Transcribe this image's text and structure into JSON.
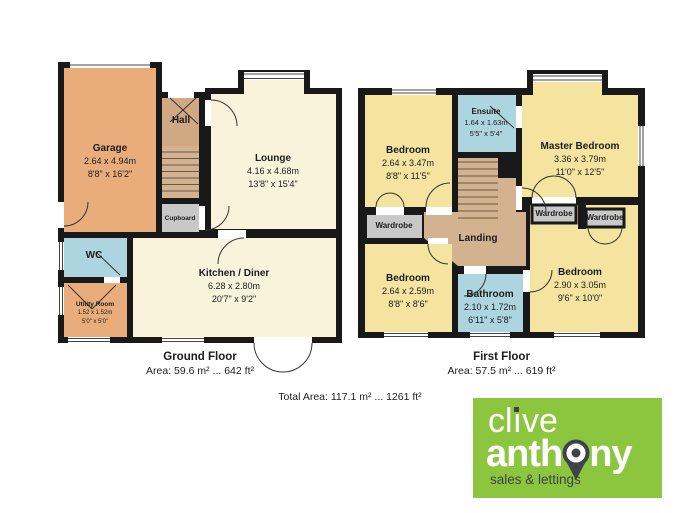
{
  "ground_floor": {
    "caption": "Ground Floor",
    "area": "Area: 59.6 m² ... 642 ft²",
    "rooms": {
      "garage": {
        "name": "Garage",
        "metric": "2.64 x 4.94m",
        "imperial": "8'8\" x 16'2\""
      },
      "hall": {
        "name": "Hall"
      },
      "lounge": {
        "name": "Lounge",
        "metric": "4.16 x 4.68m",
        "imperial": "13'8\" x 15'4\""
      },
      "cupboard": {
        "name": "Cupboard"
      },
      "wc": {
        "name": "WC"
      },
      "utility_room": {
        "name": "Utility Room",
        "metric": "1.52 x 1.52m",
        "imperial": "5'0\" x 5'0\""
      },
      "kitchen_diner": {
        "name": "Kitchen / Diner",
        "metric": "6.28 x 2.80m",
        "imperial": "20'7\" x 9'2\""
      }
    }
  },
  "first_floor": {
    "caption": "First Floor",
    "area": "Area: 57.5 m² ... 619 ft²",
    "rooms": {
      "bedroom_top_left": {
        "name": "Bedroom",
        "metric": "2.64 x 3.47m",
        "imperial": "8'8\" x 11'5\""
      },
      "ensuite": {
        "name": "Ensuite",
        "metric": "1.64 x 1.63m",
        "imperial": "5'5\" x 5'4\""
      },
      "master_bedroom": {
        "name": "Master Bedroom",
        "metric": "3.36 x 3.79m",
        "imperial": "11'0\" x 12'5\""
      },
      "wardrobe_left": {
        "name": "Wardrobe"
      },
      "wardrobe_middle": {
        "name": "Wardrobe"
      },
      "wardrobe_right": {
        "name": "Wardrobe"
      },
      "landing": {
        "name": "Landing"
      },
      "bedroom_bottom_left": {
        "name": "Bedroom",
        "metric": "2.64 x 2.59m",
        "imperial": "8'8\" x 8'6\""
      },
      "bathroom": {
        "name": "Bathroom",
        "metric": "2.10 x 1.72m",
        "imperial": "6'11\" x 5'8\""
      },
      "bedroom_bottom_right": {
        "name": "Bedroom",
        "metric": "2.90 x 3.05m",
        "imperial": "9'6\" x 10'0\""
      }
    }
  },
  "total_area": "Total Area: 117.1 m² ... 1261 ft²",
  "logo": {
    "brand_word1_pre": "cl",
    "brand_word1_i": "ı",
    "brand_word1_post": "ve",
    "brand_word2_pre": "anth",
    "brand_word2_post": "ny",
    "tagline": "sales & lettings",
    "pin_icon": "location-pin-icon",
    "colors": {
      "green": "#8CC63F",
      "charcoal": "#3E4347",
      "white": "#FFFFFF"
    }
  },
  "palette": {
    "wall": "#191919",
    "garage_orange": "#E9AC7B",
    "hall_tan": "#D0A983",
    "stairs_landing_tan": "#D3B290",
    "cream": "#FAF3DC",
    "yellow": "#F5E4A0",
    "blue": "#ACD5DF",
    "wardrobe_gray": "#C8C8C8"
  }
}
